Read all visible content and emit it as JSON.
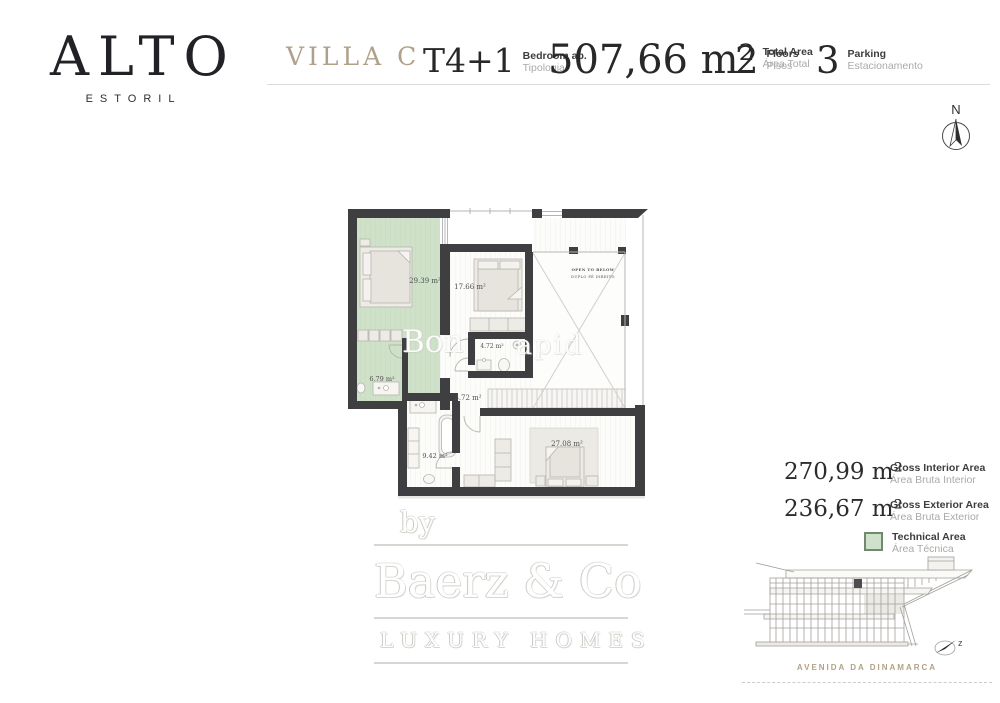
{
  "brand": {
    "name": "ALTO",
    "subtitle": "ESTORIL"
  },
  "header": {
    "villa_name": "VILLA C",
    "stats": [
      {
        "value": "T4+1",
        "label": "Bedroom ap.",
        "sublabel": "Tipologia"
      },
      {
        "value": "507,66 m²",
        "label": "Total Area",
        "sublabel": "Área Total"
      },
      {
        "value": "2",
        "label": "Floors",
        "sublabel": "Pisos"
      },
      {
        "value": "3",
        "label": "Parking",
        "sublabel": "Estacionamento"
      }
    ]
  },
  "compass": {
    "north_label": "N",
    "section_label": "z"
  },
  "plan": {
    "room_labels": {
      "master_bedroom": "29.39 m²",
      "bedroom_2": "17.66 m²",
      "bathroom_2": "4.72 m²",
      "bathroom_1": "6.79 m²",
      "hallway": "3.72 m²",
      "bathroom_3": "9.42 m²",
      "bedroom_3": "27.08 m²"
    },
    "void_label_en": "OPEN TO BELOW",
    "void_label_pt": "DUPLO PÉ DIREITO",
    "watermark_fragment_1": "Bon",
    "watermark_fragment_2": "apid"
  },
  "areas": {
    "rows": [
      {
        "value": "270,99 m²",
        "label": "Gross Interior Area",
        "sublabel": "Área Bruta Interior"
      },
      {
        "value": "236,67 m²",
        "label": "Gross Exterior Area",
        "sublabel": "Área Bruta Exterior"
      }
    ],
    "legend": {
      "label": "Technical Area",
      "sublabel": "Área Técnica",
      "swatch_color": "#cfe1ca",
      "swatch_border": "#6f8a6d"
    }
  },
  "watermark": {
    "prefix": "by",
    "name": "Baerz & Co",
    "tagline": "LUXURY HOMES"
  },
  "elevation": {
    "street_name": "AVENIDA DA DINAMARCA"
  },
  "colors": {
    "accent_gold": "#b1a089",
    "wall": "#3f3f41",
    "technical_green": "#cfe2c9",
    "text_dark": "#2c2c2e",
    "text_gray": "#a8a8a6"
  }
}
